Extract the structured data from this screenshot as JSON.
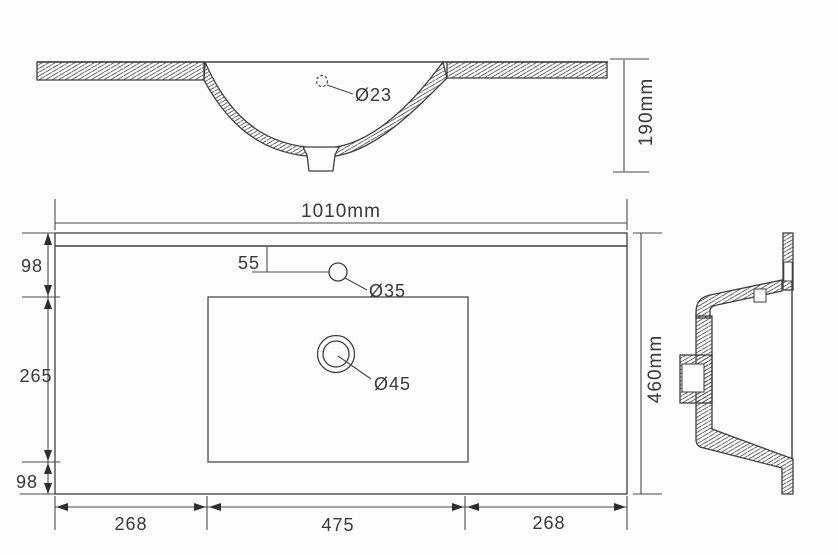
{
  "drawing": {
    "front_view": {
      "hole_label": "Ø23",
      "height_label": "190mm"
    },
    "plan_view": {
      "width_label": "1010mm",
      "depth_label": "460mm",
      "left_dims": [
        "98",
        "265",
        "98"
      ],
      "faucet_offset_label": "55",
      "faucet_hole_label": "Ø35",
      "drain_hole_label": "Ø45",
      "bottom_dims": [
        "268",
        "475",
        "268"
      ]
    },
    "colors": {
      "line": "#3f3f3f",
      "text": "#383838",
      "background": "#fdfdfd"
    }
  }
}
